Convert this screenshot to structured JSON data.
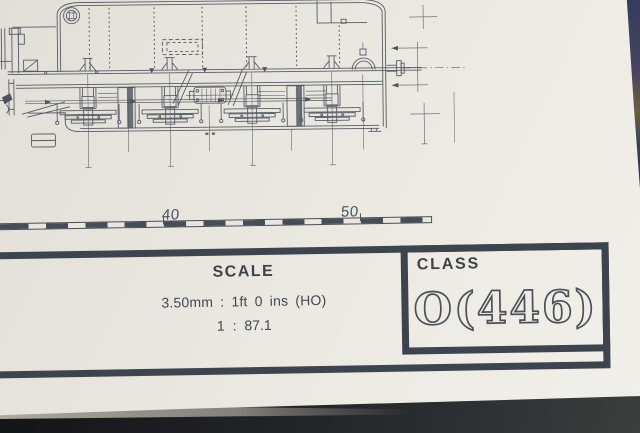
{
  "drawing": {
    "description": "side elevation technical drawing of a steam locomotive chassis"
  },
  "ruler": {
    "labels": [
      "40",
      "50"
    ]
  },
  "title_block": {
    "scale_label": "SCALE",
    "scale_line1": "3.50mm : 1ft 0 ins (HO)",
    "scale_line2": "1 : 87.1",
    "class_label": "CLASS",
    "class_value": "O(446)"
  },
  "colors": {
    "paper": "#ebe8e2",
    "ink": "#575c65",
    "border": "#3e444d",
    "desk": "#1c1e22",
    "desk_blue": "#333d5e"
  }
}
